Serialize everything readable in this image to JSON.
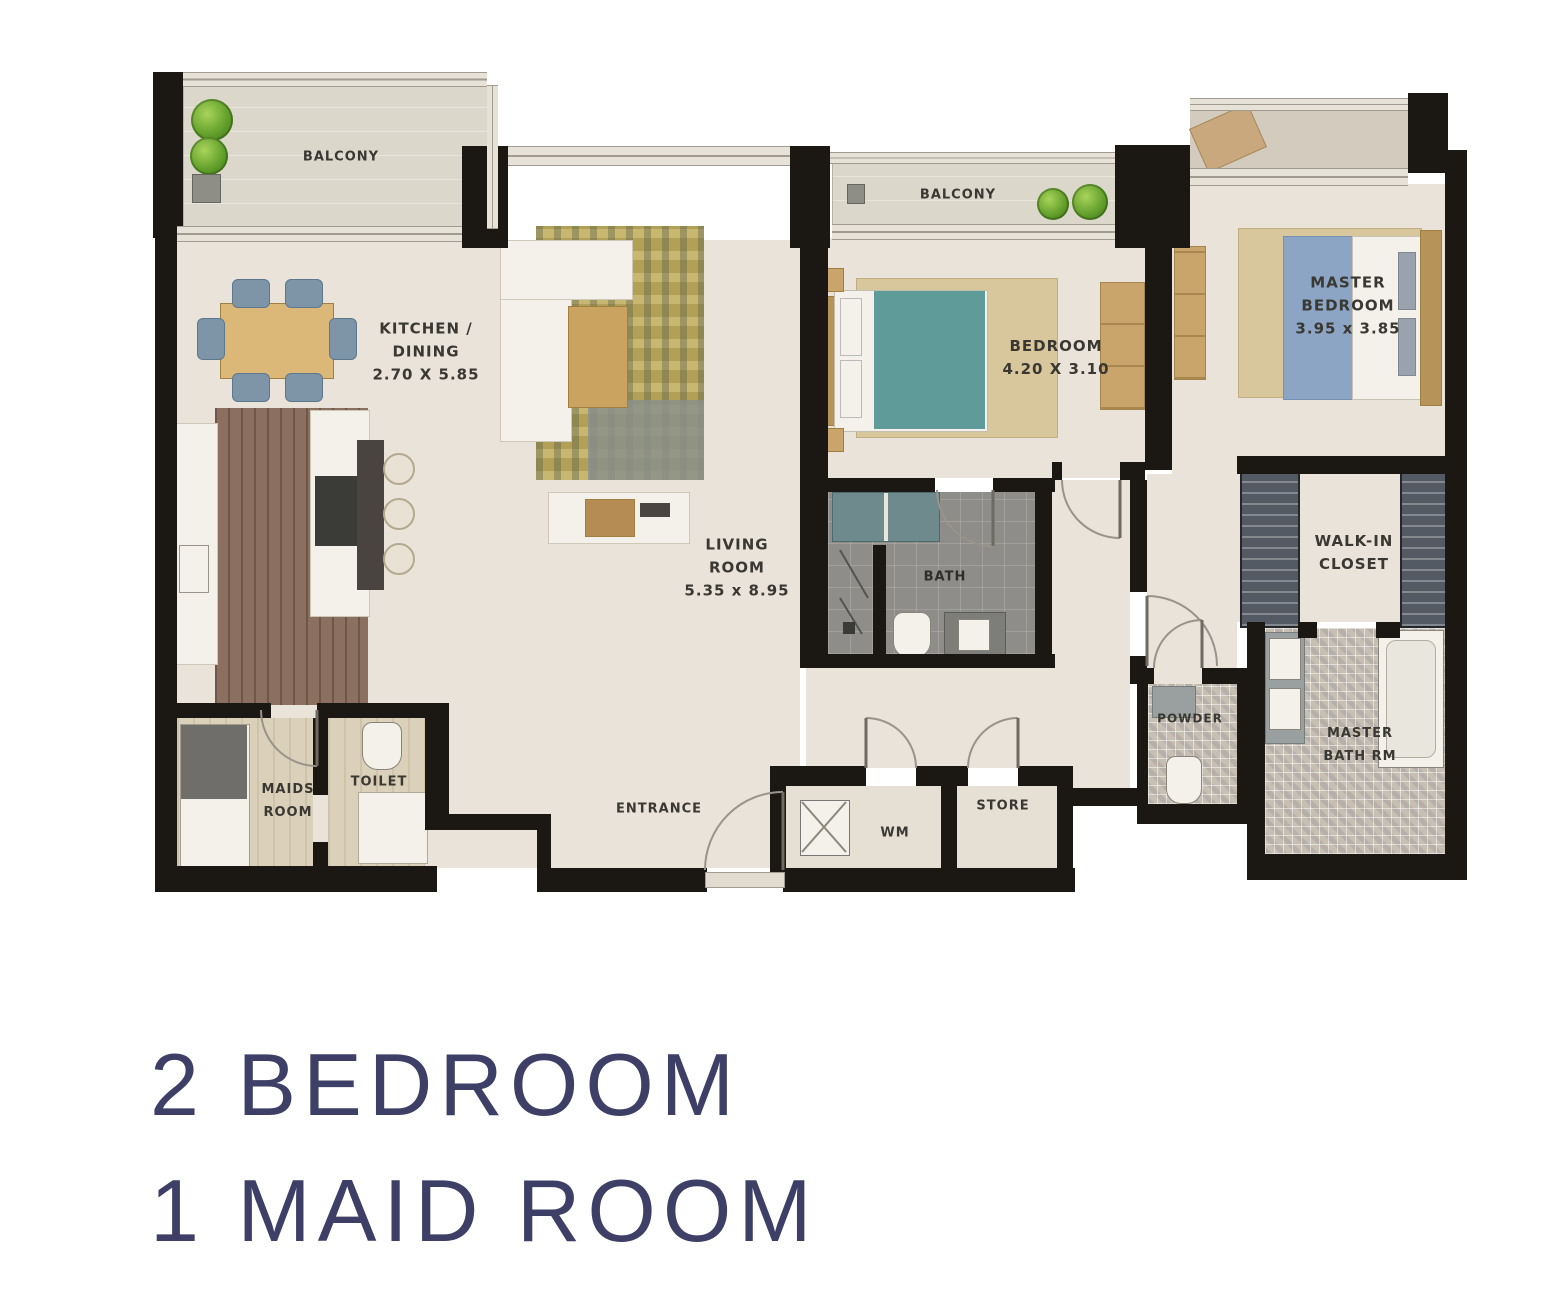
{
  "title": {
    "line1": "2 BEDROOM",
    "line2": "1 MAID ROOM"
  },
  "plan": {
    "balcony_left_label": "BALCONY",
    "balcony_mid_label": "BALCONY",
    "kitchen": {
      "line1": "KITCHEN /",
      "line2": "DINING",
      "dims": "2.70 X 5.85"
    },
    "living": {
      "line1": "LIVING",
      "line2": "ROOM",
      "dims": "5.35 x 8.95"
    },
    "bedroom": {
      "label": "BEDROOM",
      "dims": "4.20 X 3.10"
    },
    "master_bedroom": {
      "line1": "MASTER",
      "line2": "BEDROOM",
      "dims": "3.95 x 3.85"
    },
    "bath_label": "BATH",
    "walk_in_closet": {
      "line1": "WALK-IN",
      "line2": "CLOSET"
    },
    "powder_label": "POWDER",
    "master_bath": {
      "line1": "MASTER",
      "line2": "BATH RM"
    },
    "maids_room": {
      "line1": "MAIDS",
      "line2": "ROOM"
    },
    "toilet_label": "TOILET",
    "entrance_label": "ENTRANCE",
    "wm_label": "WM",
    "store_label": "STORE"
  },
  "colors": {
    "wall": "#1b1713",
    "title_text": "#3d3f66",
    "label_text": "#3a3833",
    "floor_base": "#e9e3d9",
    "bed_teal": "#5f9b99",
    "bed_blue": "#8ca5c5"
  }
}
